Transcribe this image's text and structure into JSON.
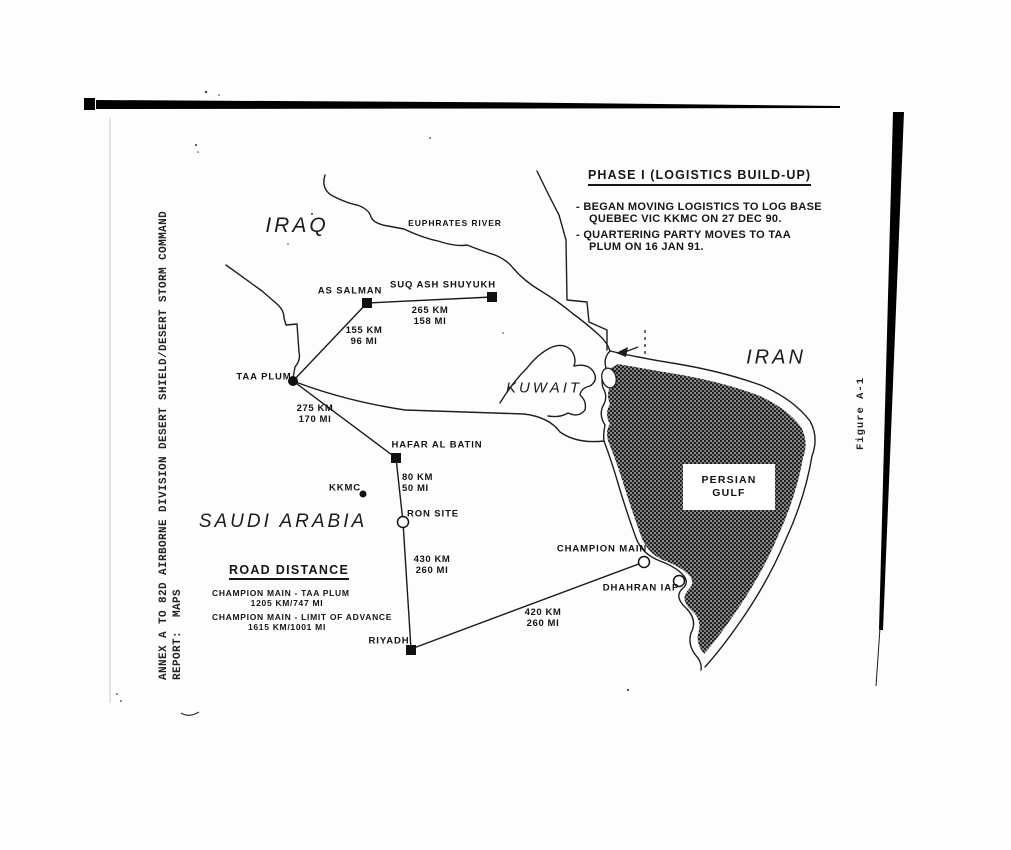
{
  "page": {
    "side_label": {
      "line1": "ANNEX A TO 82D AIRBORNE DIVISION DESERT SHIELD/DESERT STORM COMMAND",
      "line2": "REPORT:  MAPS"
    },
    "figure_label": "Figure A-1"
  },
  "phase_box": {
    "title": "PHASE I (LOGISTICS BUILD-UP)",
    "bullets": [
      {
        "lines": [
          "- BEGAN MOVING LOGISTICS TO LOG BASE",
          "QUEBEC VIC KKMC ON 27 DEC 90."
        ]
      },
      {
        "lines": [
          "- QUARTERING PARTY MOVES TO TAA",
          "PLUM ON 16 JAN 91."
        ]
      }
    ]
  },
  "road_distance_box": {
    "title": "ROAD DISTANCE",
    "entries": [
      {
        "route": "CHAMPION MAIN - TAA PLUM",
        "distance": "1205 KM/747 MI"
      },
      {
        "route": "CHAMPION MAIN - LIMIT OF ADVANCE",
        "distance": "1615 KM/1001 MI"
      }
    ]
  },
  "map": {
    "region_labels": [
      {
        "name": "iraq",
        "text": "IRAQ",
        "x": 297,
        "y": 226,
        "size": 21
      },
      {
        "name": "iran",
        "text": "IRAN",
        "x": 776,
        "y": 358,
        "size": 20
      },
      {
        "name": "kuwait",
        "text": "KUWAIT",
        "x": 544,
        "y": 388,
        "size": 15
      },
      {
        "name": "saudi-arabia",
        "text": "SAUDI ARABIA",
        "x": 283,
        "y": 522,
        "size": 19
      }
    ],
    "river_label": {
      "text": "EUPHRATES RIVER"
    },
    "gulf_label": {
      "text": "PERSIAN GULF"
    },
    "locations": [
      {
        "name": "as-salman",
        "label": "AS SALMAN",
        "marker": "square",
        "mx": 367,
        "my": 303,
        "lx": 350,
        "ly": 291
      },
      {
        "name": "suq-ash-shuyukh",
        "label": "SUQ ASH SHUYUKH",
        "marker": "square",
        "mx": 492,
        "my": 297,
        "lx": 443,
        "ly": 285
      },
      {
        "name": "taa-plum",
        "label": "TAA PLUM",
        "marker": "dot",
        "mx": 293,
        "my": 381,
        "lx": 264,
        "ly": 377
      },
      {
        "name": "hafar-al-batin",
        "label": "HAFAR AL BATIN",
        "marker": "square",
        "mx": 396,
        "my": 458,
        "lx": 437,
        "ly": 445
      },
      {
        "name": "kkmc",
        "label": "KKMC",
        "marker": "dot-small",
        "mx": 363,
        "my": 494,
        "lx": 345,
        "ly": 488
      },
      {
        "name": "ron-site",
        "label": "RON SITE",
        "marker": "circle",
        "mx": 403,
        "my": 522,
        "lx": 433,
        "ly": 514
      },
      {
        "name": "champion-main",
        "label": "CHAMPION MAIN",
        "marker": "circle",
        "mx": 644,
        "my": 562,
        "lx": 602,
        "ly": 549
      },
      {
        "name": "dhahran-iap",
        "label": "DHAHRAN IAP",
        "marker": "circle",
        "mx": 679,
        "my": 581,
        "lx": 641,
        "ly": 588
      },
      {
        "name": "riyadh",
        "label": "RIYADH",
        "marker": "square",
        "mx": 411,
        "my": 650,
        "lx": 389,
        "ly": 641
      }
    ],
    "roads": [
      {
        "from": "as-salman",
        "to": "suq-ash-shuyukh",
        "x1": 367,
        "y1": 303,
        "x2": 492,
        "y2": 297
      },
      {
        "from": "taa-plum",
        "to": "as-salman",
        "x1": 293,
        "y1": 381,
        "x2": 367,
        "y2": 303
      },
      {
        "from": "taa-plum",
        "to": "hafar-al-batin",
        "x1": 293,
        "y1": 381,
        "x2": 396,
        "y2": 458
      },
      {
        "from": "hafar-al-batin",
        "to": "ron-site",
        "x1": 396,
        "y1": 458,
        "x2": 403,
        "y2": 522
      },
      {
        "from": "ron-site",
        "to": "riyadh",
        "x1": 403,
        "y1": 522,
        "x2": 411,
        "y2": 649
      },
      {
        "from": "riyadh",
        "to": "champion-main",
        "x1": 411,
        "y1": 649,
        "x2": 644,
        "y2": 562
      }
    ],
    "distances": [
      {
        "km": "265 KM",
        "mi": "158 MI",
        "x": 430,
        "y": 306,
        "align": "center"
      },
      {
        "km": "155 KM",
        "mi": "96 MI",
        "x": 364,
        "y": 326,
        "align": "center"
      },
      {
        "km": "275 KM",
        "mi": "170 MI",
        "x": 315,
        "y": 404,
        "align": "center"
      },
      {
        "km": "80 KM",
        "mi": "50 MI",
        "x": 402,
        "y": 473,
        "align": "left"
      },
      {
        "km": "430 KM",
        "mi": "260 MI",
        "x": 432,
        "y": 555,
        "align": "center"
      },
      {
        "km": "420 KM",
        "mi": "260 MI",
        "x": 543,
        "y": 608,
        "align": "center"
      }
    ]
  },
  "colors": {
    "ink": "#161616",
    "gulf_base": "#7a7a7a",
    "gulf_dot": "#101010",
    "gulf_speck": "#dcdcdc"
  }
}
